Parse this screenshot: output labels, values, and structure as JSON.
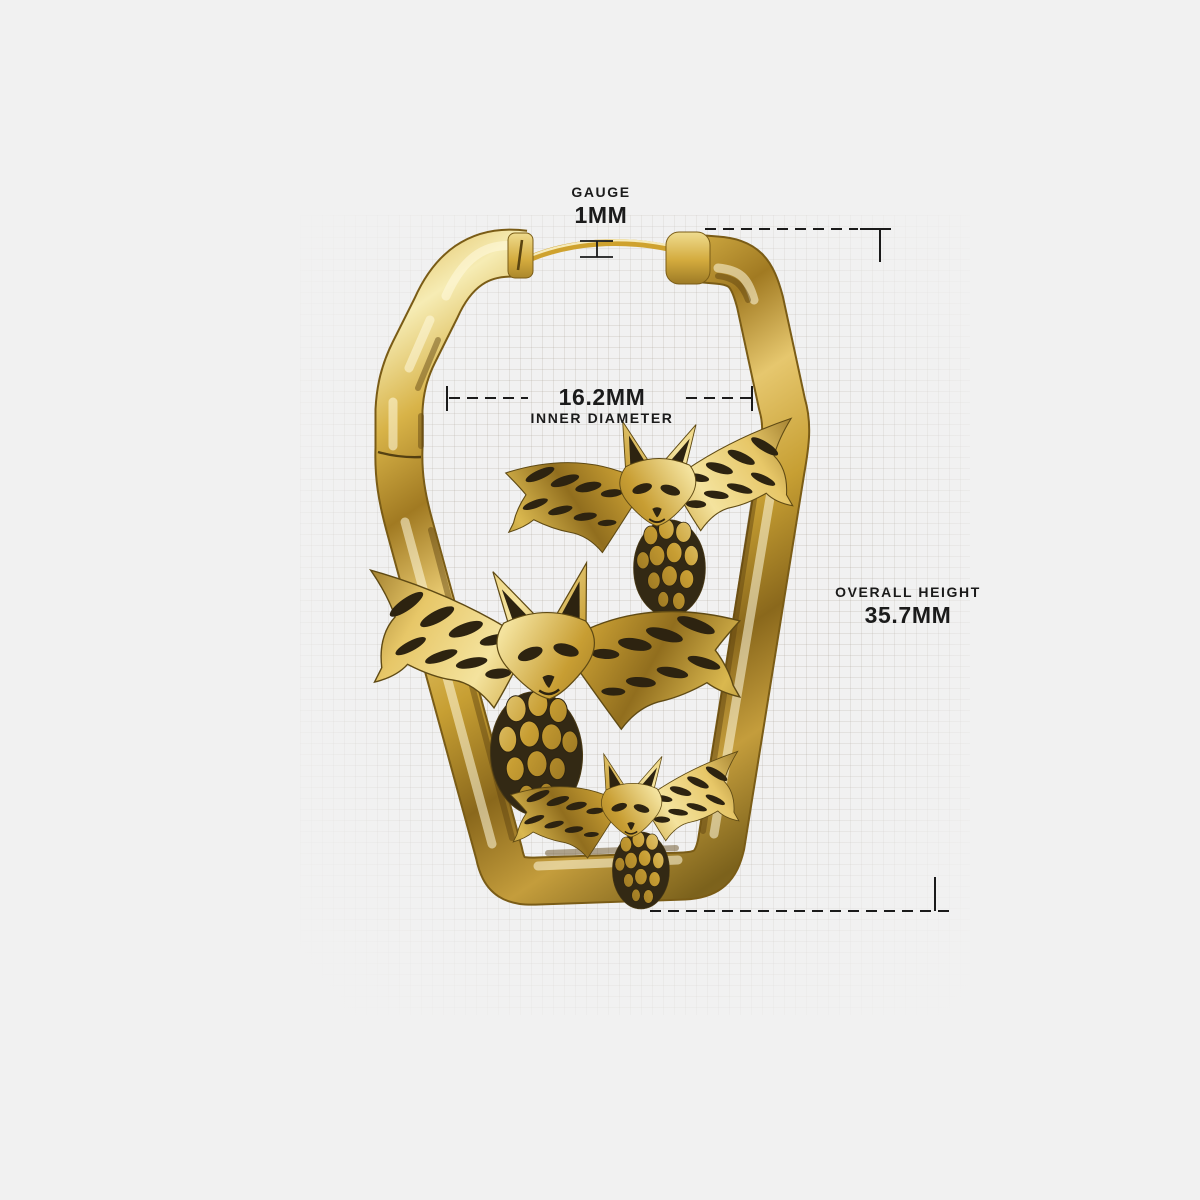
{
  "page": {
    "background_color": "#f1f1f1",
    "description": "Product dimension diagram of a gold coffin-shaped hoop earring decorated with three antique bat figures, shown over faint graph paper with measurement callouts"
  },
  "annotations": {
    "gauge": {
      "label": "GAUGE",
      "value": "1MM"
    },
    "inner_diameter": {
      "value": "16.2MM",
      "label": "INNER DIAMETER"
    },
    "overall_height": {
      "label": "OVERALL HEIGHT",
      "value": "35.7MM"
    }
  },
  "illustration": {
    "subject": "coffin-shaped huggie hoop earring with three bats and hinged ear wire",
    "colors": {
      "gold_highlight": "#f7ecb4",
      "gold_mid": "#d2a63d",
      "gold_deep": "#8a681c",
      "gold_shadow": "#6b5115",
      "engraving_dark": "#2d2310",
      "annotation_line": "#1a1a1a",
      "grid_line": "#dedad4",
      "text": "#1b1b1b"
    }
  }
}
